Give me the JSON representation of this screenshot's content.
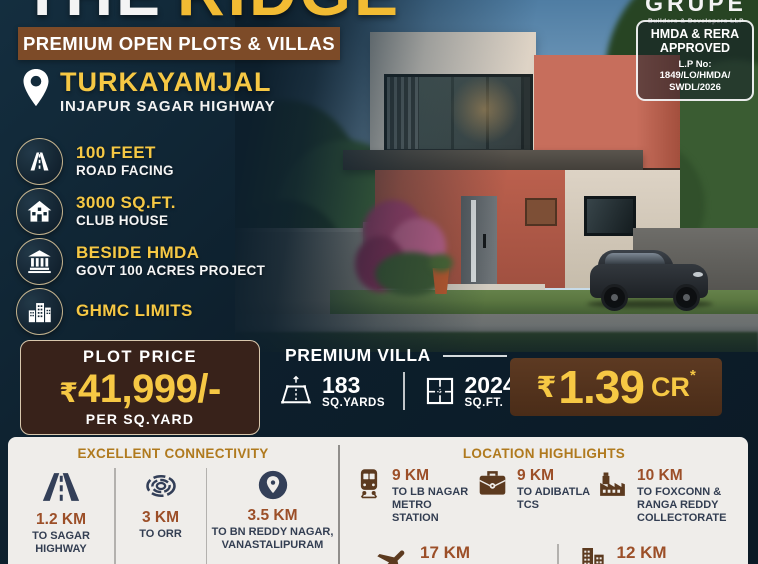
{
  "poster": {
    "title_word1": "THE",
    "title_word2": "RIDGE",
    "banner": "PREMIUM OPEN PLOTS & VILLAS",
    "location_name": "TURKAYAMJAL",
    "location_sub": "INJAPUR SAGAR HIGHWAY"
  },
  "brand": {
    "name": "GRUPE",
    "tagline": "Builders & Developers LLP"
  },
  "approval": {
    "line1": "HMDA & RERA",
    "line2": "APPROVED",
    "lp_label": "L.P No:",
    "lp_value1": "1849/LO/HMDA/",
    "lp_value2": "SWDL/2026"
  },
  "features": [
    {
      "icon": "road-icon",
      "title": "100 FEET",
      "subtitle": "ROAD FACING"
    },
    {
      "icon": "clubhouse-icon",
      "title": "3000 SQ.FT.",
      "subtitle": "CLUB HOUSE"
    },
    {
      "icon": "govt-building-icon",
      "title": "BESIDE HMDA",
      "subtitle": "GOVT 100 ACRES PROJECT"
    },
    {
      "icon": "city-buildings-icon",
      "title": "GHMC LIMITS",
      "subtitle": ""
    }
  ],
  "plot_price": {
    "label": "PLOT PRICE",
    "currency": "₹",
    "amount": "41,999/-",
    "unit": "PER SQ.YARD"
  },
  "villa": {
    "heading": "PREMIUM VILLA",
    "area_value": "183",
    "area_unit": "SQ.YARDS",
    "builtup_value": "2024",
    "builtup_unit": "SQ.FT.",
    "price_currency": "₹",
    "price_value": "1.39",
    "price_suffix": "CR",
    "price_note": "*"
  },
  "connectivity": {
    "heading": "EXCELLENT CONNECTIVITY",
    "items": [
      {
        "icon": "highway-icon",
        "distance": "1.2 KM",
        "to": "TO SAGAR\nHIGHWAY"
      },
      {
        "icon": "orr-icon",
        "distance": "3 KM",
        "to": "TO ORR"
      },
      {
        "icon": "location-pin-icon",
        "distance": "3.5 KM",
        "to": "TO BN REDDY NAGAR,\nVANASTALIPURAM"
      }
    ]
  },
  "highlights": {
    "heading": "LOCATION HIGHLIGHTS",
    "row1": [
      {
        "icon": "metro-icon",
        "distance": "9 KM",
        "to": "TO LB NAGAR\nMETRO STATION"
      },
      {
        "icon": "briefcase-icon",
        "distance": "9 KM",
        "to": "TO ADIBATLA\nTCS"
      },
      {
        "icon": "factory-icon",
        "distance": "10 KM",
        "to": "TO FOXCONN &\nRANGA REDDY\nCOLLECTORATE"
      }
    ],
    "row2": [
      {
        "icon": "airplane-icon",
        "distance": "17 KM",
        "to": "TO RAJIV GANDHI"
      },
      {
        "icon": "city-icon",
        "distance": "12 KM",
        "to": "TO FAB CITY"
      }
    ]
  },
  "colors": {
    "navy_bg": "#0d1f2c",
    "gold": "#f6c844",
    "banner_brown": "#7d4b28",
    "price_box_brown": "#38221a",
    "cr_box_brown": "#573621",
    "section_heading_gold": "#b07a1e",
    "distance_rust": "#9c4f28",
    "icon_navy": "#333f58",
    "icon_brown": "#5c3a1f",
    "card_bg": "#efedea"
  }
}
